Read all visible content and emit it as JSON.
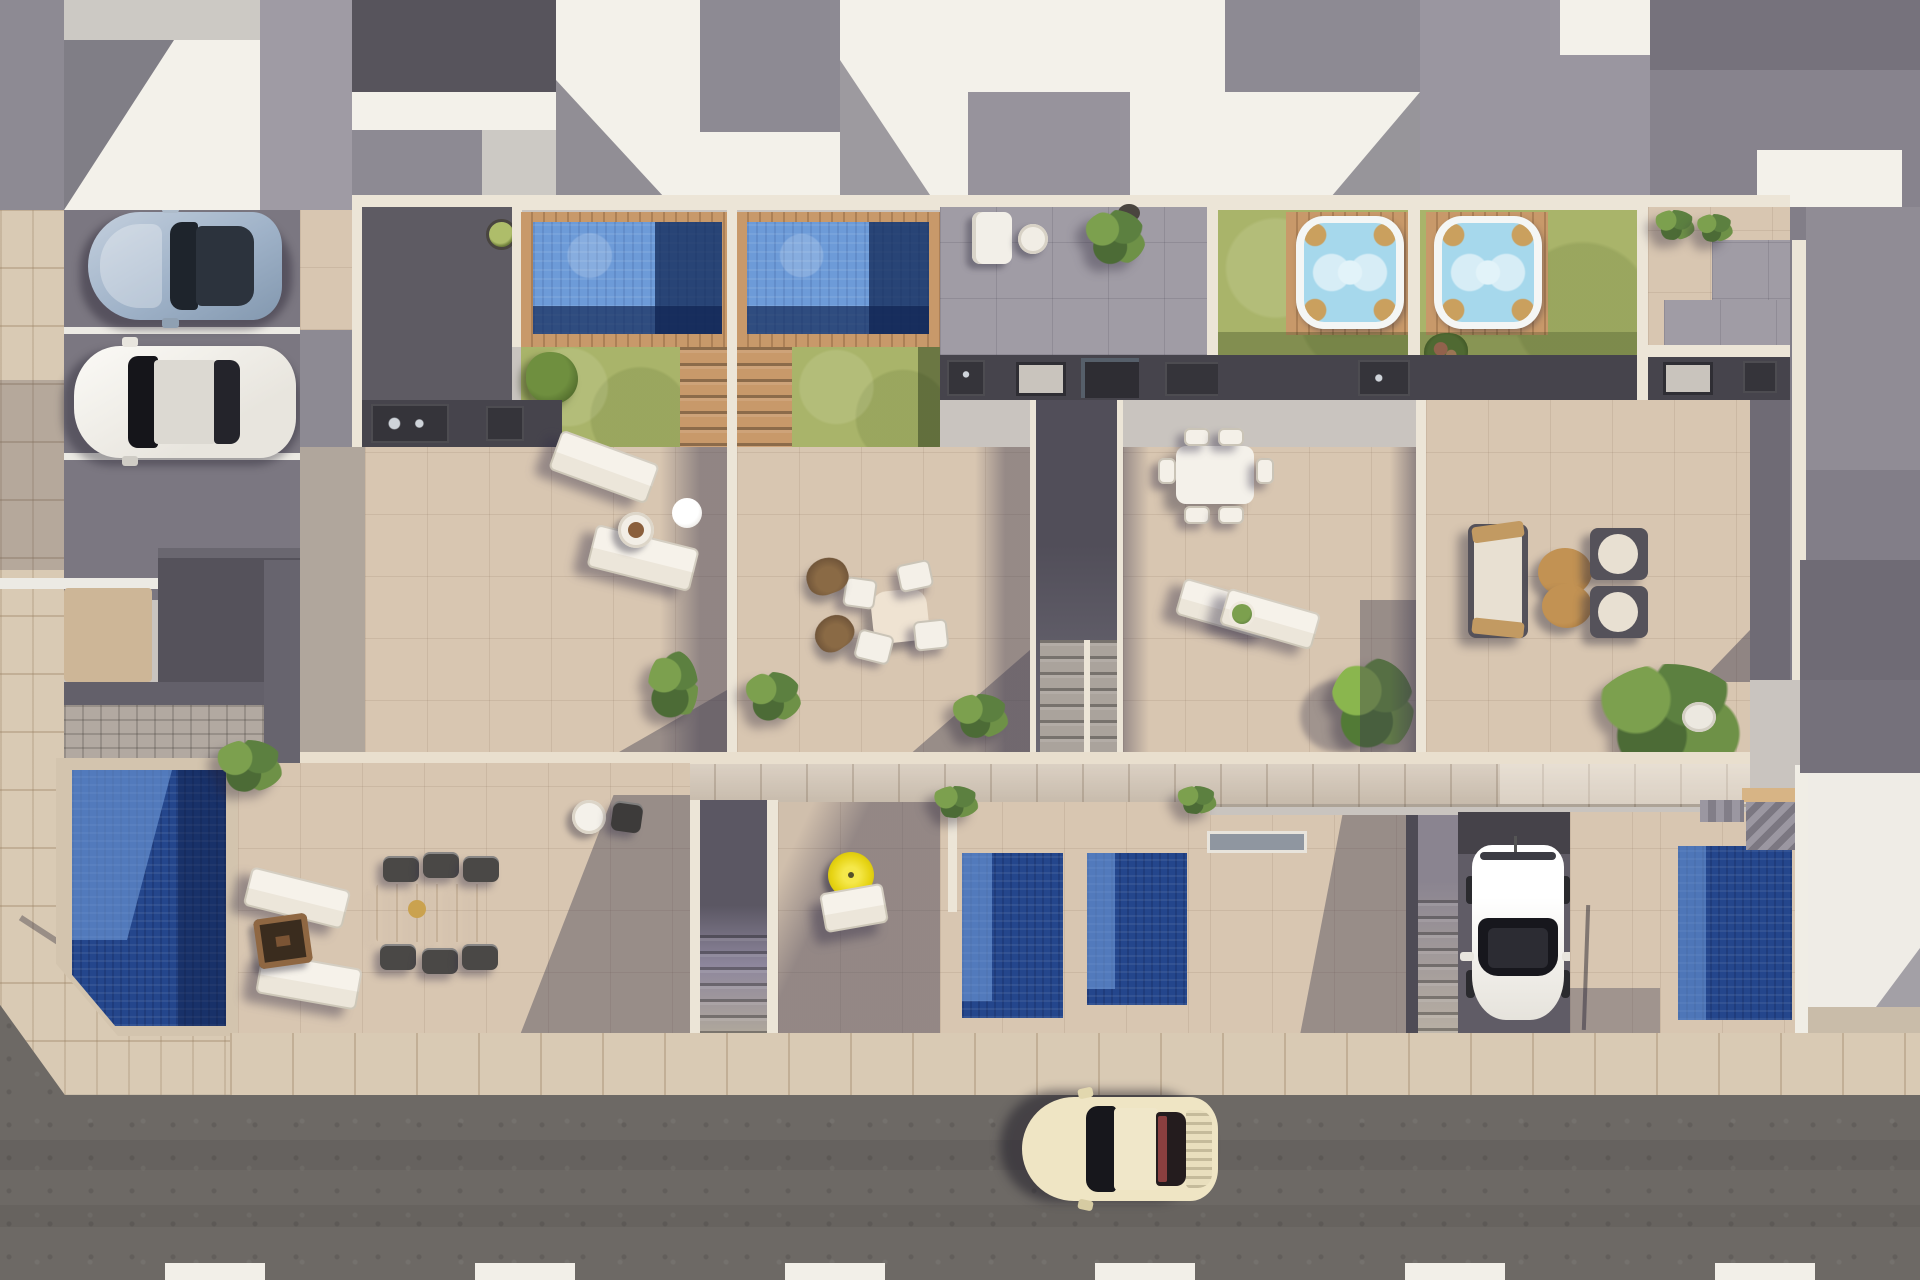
{
  "scene": {
    "type": "aerial architectural render",
    "view": "top-down",
    "subject": "row of four modern townhouses with rooftop pool terraces, ground-level patios with plunge pools, street and parking",
    "lighting": "bright midday sun casting hard diagonal shadows toward lower-left"
  },
  "palette": {
    "base": "#c9c4bf",
    "road": "#6d6965",
    "sidewalk": "#d9cab4",
    "parking_asphalt": "#7b7781",
    "terrace_tile": "#d8c6b1",
    "gray_patio": "#a09ca5",
    "white_roof": "#f3f1ea",
    "gray_roof": "#8d8a93",
    "dark_roof": "#57545c",
    "white_wall": "#ece5d7",
    "kitchen_band": "#46444c",
    "counter": "#35343a",
    "lawn": "#a9b46a",
    "wood_deck": "#c8996a",
    "wood_walkway": "#d3c6b6",
    "pool_light": "#6d9bd8",
    "pool_deep": "#1c3e7c",
    "plunge_pool": "#24468c",
    "plunge_light": "#5d8cd8",
    "hot_tub_water": "#a6d8ec",
    "paver_band": "#b2a9a1",
    "sand_patch": "#cdb697",
    "parasol_yellow": "#e6d312",
    "coffee_table_ochre": "#b5823f",
    "fire_pit_brown": "#7b5434",
    "car_silver": "#9fb2c8",
    "car_white": "#f1efe9",
    "car_cream": "#efe5c4",
    "road_dash": "#f2efe8",
    "shadow_tint": "rgba(58,54,76,0.40)"
  },
  "counts": {
    "townhouse_units": 4,
    "rooftop_pools": 2,
    "hot_tubs": 2,
    "ground_level_pools": 4,
    "cars": 4,
    "road_dashes": 6,
    "parking_stripes": 3
  },
  "objects": {
    "cars": [
      {
        "name": "silver sports car",
        "area": "parking bay top-left"
      },
      {
        "name": "white sedan",
        "area": "parking bay top-left, below silver car"
      },
      {
        "name": "white hatchback",
        "area": "private driveway centre-right, nose toward street"
      },
      {
        "name": "cream classic coupe",
        "area": "driving on street at bottom, heading left"
      }
    ],
    "water_features": [
      {
        "name": "unit-1 rooftop pool",
        "area": "top-centre-left, wood deck surround"
      },
      {
        "name": "unit-2 rooftop pool",
        "area": "top-centre, wood deck surround"
      },
      {
        "name": "unit-3 hot tub",
        "area": "top-right lawn on square wood deck"
      },
      {
        "name": "unit-4 hot tub",
        "area": "top-right lawn on square wood deck"
      },
      {
        "name": "west garden pool",
        "area": "bottom-left with angled street corner"
      },
      {
        "name": "plunge pool A",
        "area": "lower centre"
      },
      {
        "name": "plunge pool B",
        "area": "lower centre, right of A"
      },
      {
        "name": "east plunge pool",
        "area": "lower right"
      }
    ],
    "furniture": [
      {
        "name": "two sun loungers with tray table and globe lamp",
        "area": "unit-1 terrace"
      },
      {
        "name": "oval dining table with four chairs and two wicker chairs",
        "area": "unit-2 terrace"
      },
      {
        "name": "rectangular dining table with six chairs",
        "area": "unit-3 terrace"
      },
      {
        "name": "two sun loungers with potted plant",
        "area": "unit-3 terrace"
      },
      {
        "name": "lounge set: sofa, two armchairs, two ochre coffee tables",
        "area": "unit-4 terrace"
      },
      {
        "name": "corner sofa, round side table and parasol base",
        "area": "grey upper patio"
      },
      {
        "name": "two loungers and square fire pit",
        "area": "west garden beside pool"
      },
      {
        "name": "timber dining table with six dark chairs",
        "area": "west garden"
      },
      {
        "name": "white bistro table with chair",
        "area": "unit-1 lower patio"
      },
      {
        "name": "yellow parasol with lounger",
        "area": "shaded lower patio"
      }
    ],
    "vegetation": [
      {
        "name": "round planter tree",
        "area": "unit-1 dark roof"
      },
      {
        "name": "garden tree",
        "area": "unit-1 lawn"
      },
      {
        "name": "assorted palms",
        "area": "terraces and gardens"
      },
      {
        "name": "large leafy plant",
        "area": "unit-3 terrace"
      },
      {
        "name": "flowering shrub",
        "area": "unit-4 lawn edge"
      }
    ],
    "structures": [
      {
        "name": "outdoor kitchen counters",
        "area": "dark band at top of each terrace"
      },
      {
        "name": "double staircase",
        "area": "between units 2 and 3"
      },
      {
        "name": "staircases to lower gardens",
        "area": "between lower patios"
      },
      {
        "name": "timber walkway band",
        "area": "across full width between terrace and garden levels"
      },
      {
        "name": "dashed centre line",
        "area": "street bottom edge"
      },
      {
        "name": "neighbouring white roof terrace",
        "area": "right edge"
      }
    ]
  }
}
